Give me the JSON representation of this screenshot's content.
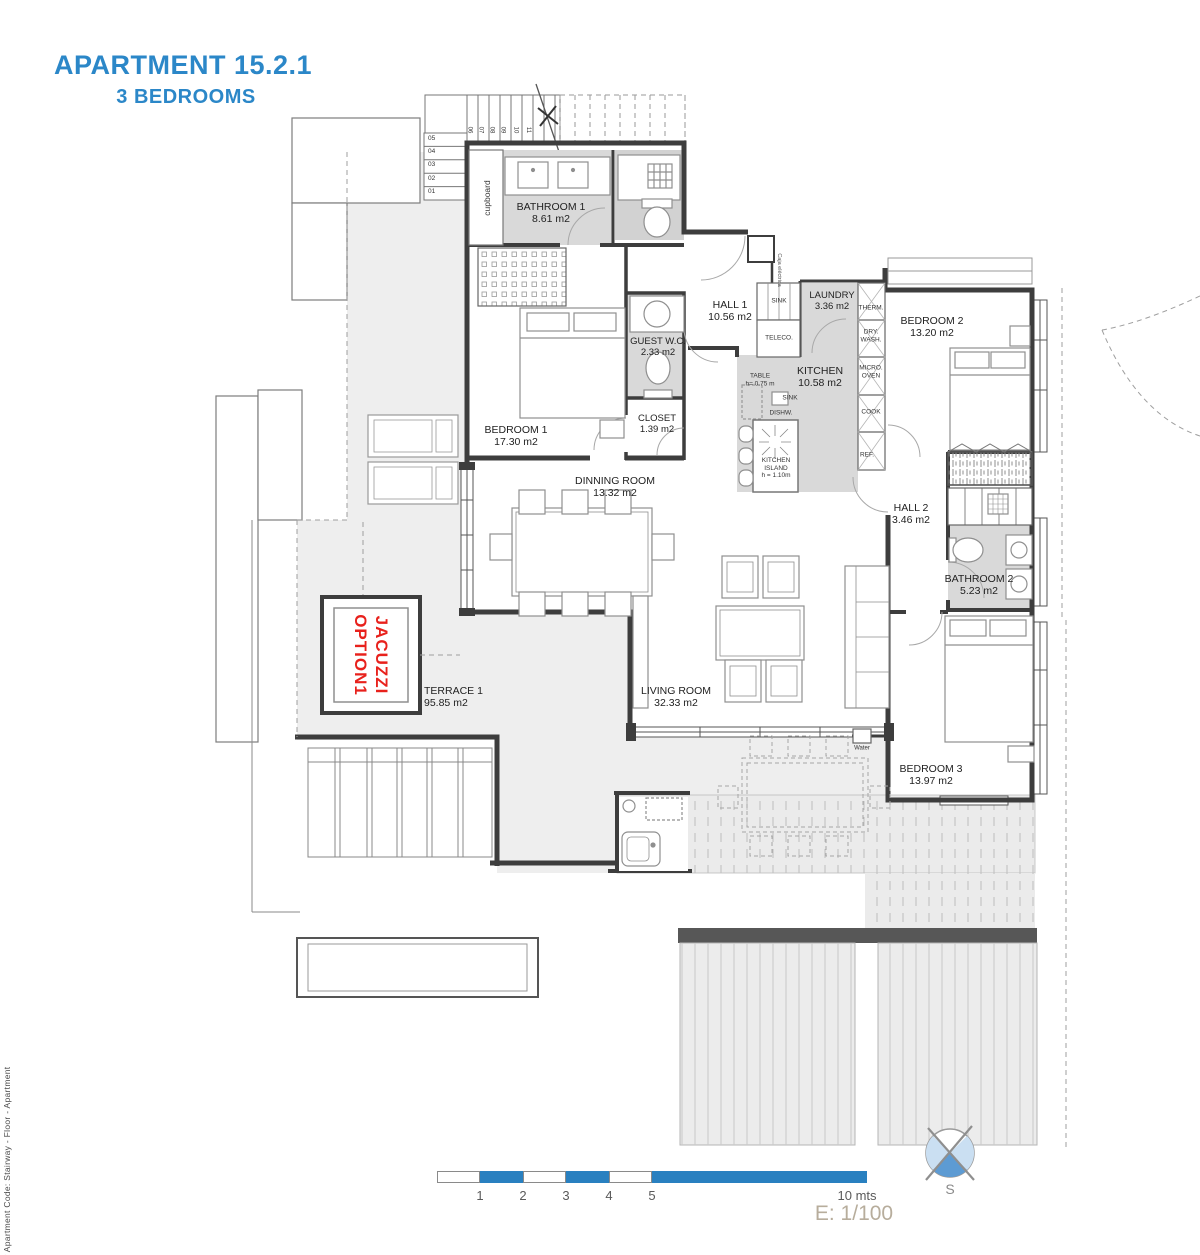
{
  "title": {
    "line1": "APARTMENT 15.2.1",
    "line2": "3 BEDROOMS"
  },
  "side_note": "* Apartment Code: Stairway - Floor - Apartment",
  "rooms": {
    "bathroom1": {
      "name": "BATHROOM 1",
      "area": "8.61 m2"
    },
    "bedroom1": {
      "name": "BEDROOM 1",
      "area": "17.30 m2"
    },
    "guest_wc": {
      "name": "GUEST W.C.",
      "area": "2.33 m2"
    },
    "closet": {
      "name": "CLOSET",
      "area": "1.39 m2"
    },
    "hall1": {
      "name": "HALL 1",
      "area": "10.56 m2"
    },
    "laundry": {
      "name": "LAUNDRY",
      "area": "3.36 m2"
    },
    "kitchen": {
      "name": "KITCHEN",
      "area": "10.58 m2"
    },
    "bedroom2": {
      "name": "BEDROOM 2",
      "area": "13.20 m2"
    },
    "hall2": {
      "name": "HALL 2",
      "area": "3.46 m2"
    },
    "bathroom2": {
      "name": "BATHROOM 2",
      "area": "5.23 m2"
    },
    "dinning": {
      "name": "DINNING ROOM",
      "area": "13.32 m2"
    },
    "living": {
      "name": "LIVING ROOM",
      "area": "32.33 m2"
    },
    "bedroom3": {
      "name": "BEDROOM 3",
      "area": "13.97 m2"
    },
    "terrace": {
      "name": "TERRACE 1",
      "area": "95.85 m2"
    }
  },
  "fixtures": {
    "sink1": "SINK",
    "teleco": "TELECO.",
    "therm": "THERM.",
    "dry_wash": "DRY.\nWASH.",
    "micro_oven": "MICRO.\nOVEN",
    "cook": "COOK",
    "ref": "REF.",
    "sink2": "SINK",
    "dishw": "DISHW.",
    "table": "TABLE\nh= 0.75 m",
    "island": "KITCHEN\nISLAND\nh = 1.10m",
    "water": "Water",
    "cupboard": "cupboard",
    "caja": "Caja eléctrica"
  },
  "jacuzzi": {
    "line1": "JACUZZI",
    "line2": "OPTION1"
  },
  "stairs": {
    "left": [
      "05",
      "04",
      "03",
      "02",
      "01"
    ],
    "top": [
      "06",
      "07",
      "08",
      "09",
      "10",
      "11"
    ]
  },
  "scale_bar": {
    "ticks": [
      "1",
      "2",
      "3",
      "4",
      "5"
    ],
    "end_label": "10 mts",
    "scale_note": "E: 1/100"
  },
  "compass": {
    "south": "S"
  },
  "colors": {
    "accent_blue": "#2b87c8",
    "jacuzzi_red": "#e8211c",
    "scale_blue": "#2980c0",
    "scale_note_color": "#b7ad9c"
  }
}
